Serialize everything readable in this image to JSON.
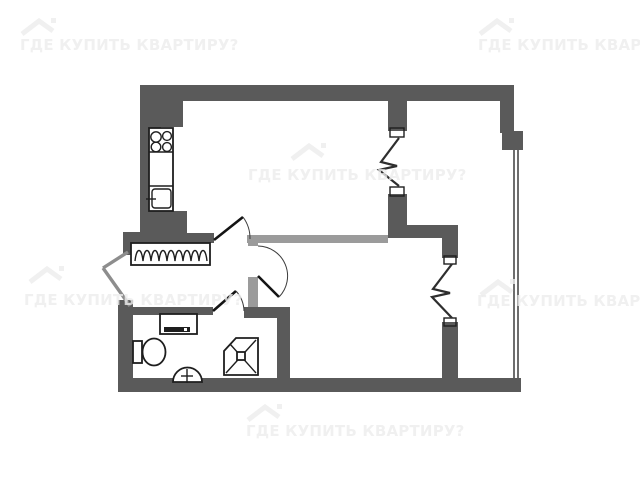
{
  "watermark": {
    "text": "ГДЕ КУПИТЬ КВАРТИРУ?",
    "icon": "roof-logo-icon",
    "visible_instances": 6,
    "color": "#ededed"
  },
  "colors": {
    "background": "#ffffff",
    "wall_dark": "#5a5a5a",
    "wall_partition": "#9b9b9b",
    "fixture_stroke": "#1e1e1e",
    "balcony_glazing": "#4a4a4a"
  },
  "floorplan": {
    "type": "apartment-floor-plan",
    "fixtures": [
      "stove-icon",
      "kitchen-counter",
      "kitchen-sink-icon",
      "coat-rack-icon",
      "washing-machine-icon",
      "toilet-icon",
      "washbasin-icon",
      "shower-cabin-icon"
    ],
    "doors": [
      "entrance-door",
      "kitchen-door-swing",
      "bedroom-door-swing",
      "bathroom-door-swing",
      "closet-accordion-door",
      "balcony-accordion-door"
    ],
    "glazing": "balcony-glazing"
  }
}
